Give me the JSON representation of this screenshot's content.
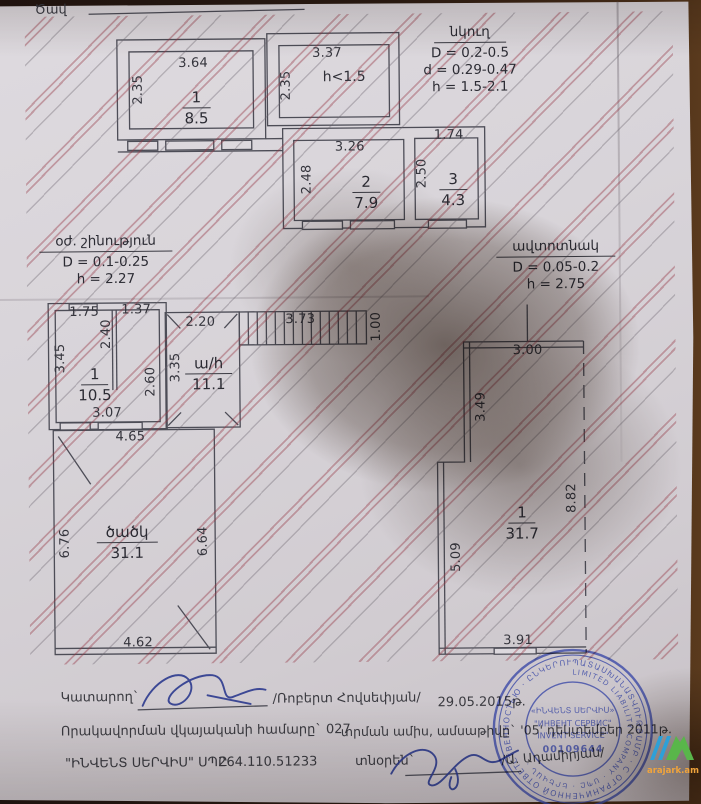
{
  "document": {
    "top_label": "Ծավ",
    "legends": {
      "basement": {
        "title": "նկուղ",
        "line1": "D = 0.2-0.5",
        "line2": "d = 0.29-0.47",
        "line3": "h = 1.5-2.1"
      },
      "aux_building": {
        "title": "օժ. շինություն",
        "line1": "D = 0.1-0.25",
        "line2": "h = 2.27"
      },
      "garage": {
        "title": "ավտոտնակ",
        "line1": "D = 0.05-0.2",
        "line2": "h = 2.75"
      }
    },
    "upper_plan": {
      "room1": {
        "num": "1",
        "area": "8.5",
        "w": "3.64",
        "h": "2.35"
      },
      "attic": {
        "w": "3.37",
        "h": "2.35",
        "note": "h<1.5"
      },
      "room2": {
        "num": "2",
        "area": "7.9",
        "w": "3.26",
        "h": "2.48"
      },
      "room3": {
        "num": "3",
        "area": "4.3",
        "w": "1.74",
        "h": "2.50"
      }
    },
    "middle_plan": {
      "room1": {
        "num": "1",
        "area": "10.5",
        "top_left": "1.75",
        "top_right": "1.37",
        "partition": "2.40",
        "left": "3.45",
        "right": "2.60",
        "bottom": "3.07"
      },
      "hall": {
        "label": "ա/h",
        "area": "11.1",
        "top": "2.20",
        "left": "3.35"
      },
      "stairs": {
        "length": "3.73",
        "width": "1.00"
      },
      "canopy": {
        "label": "ծածկ",
        "area": "31.1",
        "top": "4.65",
        "left": "6.76",
        "right": "6.64",
        "bottom": "4.62"
      }
    },
    "garage_plan": {
      "room1": {
        "num": "1",
        "area": "31.7",
        "top": "3.00",
        "left_upper": "3.49",
        "left_lower": "5.09",
        "right": "8.82",
        "bottom": "3.91"
      }
    },
    "footer": {
      "executor_label": "Կատարող`",
      "executor_name": "/Ռոբերտ Հովսեփյան/",
      "date": "29.05.2015թ.",
      "qualification": "Որակավորման վկայականի համարը` 027",
      "issue_date": "տրման ամիս, ամսաթիվը` '05' դեկտեմբեր 2011թ.",
      "company": "\"ԻՆՎԵՆՏ ՍԵՐՎԻՍ\" ՍՊԸ",
      "tax_id": "264.110.51233",
      "director_label": "տնօրեն`",
      "director_name": "/Ա. Ադամիրյան/"
    },
    "stamp": {
      "ring_outer": "ՊԱՏԱՍԽԱՆԱՏՎՈՒԹՅԱՄԲ · С ОГРАНИЧЕННОЙ ОТВЕТСТВЕННОСТЬЮ · ԸՆԿԵՐՈՒԹՅՈՒՆ ·",
      "ring_inner": "LIMITED LIABILITY COMPANY · ՍՊԸ · ԵՐԵՎԱՆ ·",
      "center1": "«ԻՆՎԵՆՏ ՍԵՐՎԻՍ»",
      "center2": "\"ИНВЕНТ СЕРВИС\"",
      "center3": "INVENT SERVICE\"",
      "number": "00109644"
    },
    "watermark": "arajark.am",
    "colors": {
      "paper": "#d8d4d9",
      "ink": "#44444e",
      "hatch_red": "#8c3648",
      "stamp_blue": "#3f4da8",
      "signature_blue": "#2c3a8e",
      "logo_green": "#59b64a",
      "logo_blue": "#2da0d8",
      "logo_text": "#f0a43c"
    }
  }
}
